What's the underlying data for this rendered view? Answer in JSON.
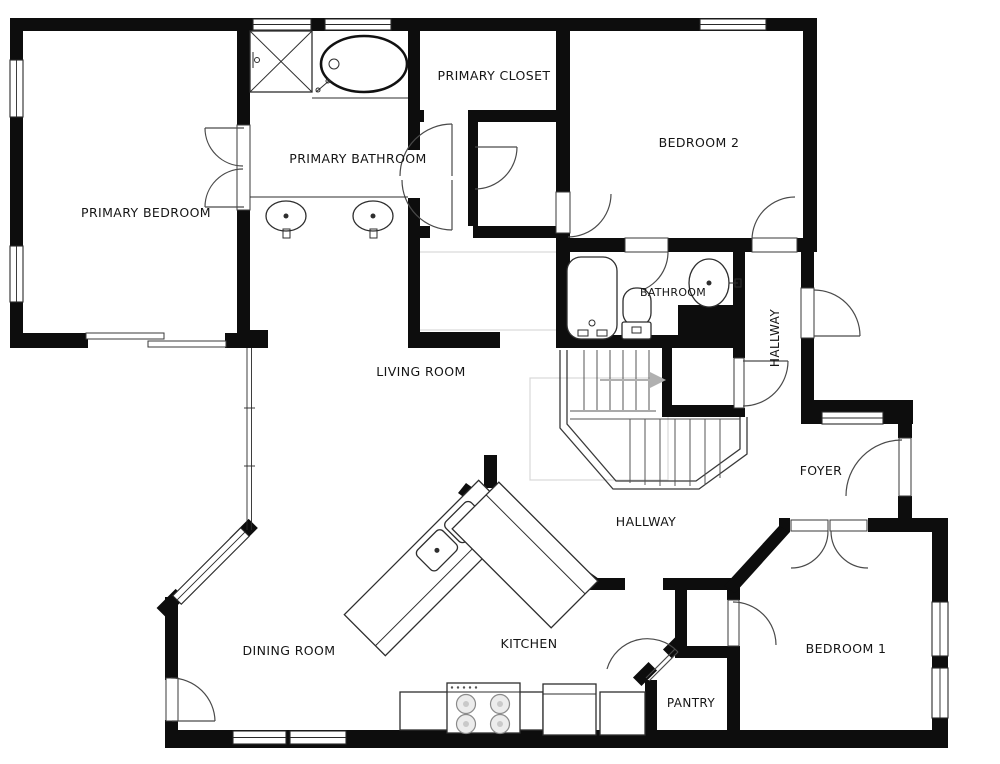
{
  "plan": {
    "type": "residential-floor-plan",
    "colors": {
      "wall": "#0d0d0d",
      "background": "#ffffff",
      "door_arc": "#4a4a4a",
      "guide_gray": "#d8d8d8",
      "label_text": "#151515"
    }
  },
  "rooms": {
    "primary_bedroom": {
      "label": "PRIMARY BEDROOM"
    },
    "primary_bathroom": {
      "label": "PRIMARY BATHROOM"
    },
    "primary_closet": {
      "label": "PRIMARY CLOSET"
    },
    "bedroom_2": {
      "label": "BEDROOM 2"
    },
    "bathroom": {
      "label": "BATHROOM"
    },
    "hallway_upper": {
      "label": "HALLWAY"
    },
    "foyer": {
      "label": "FOYER"
    },
    "living_room": {
      "label": "LIVING ROOM"
    },
    "hallway_lower": {
      "label": "HALLWAY"
    },
    "dining_room": {
      "label": "DINING ROOM"
    },
    "kitchen": {
      "label": "KITCHEN"
    },
    "pantry": {
      "label": "PANTRY"
    },
    "bedroom_1": {
      "label": "BEDROOM 1"
    }
  }
}
